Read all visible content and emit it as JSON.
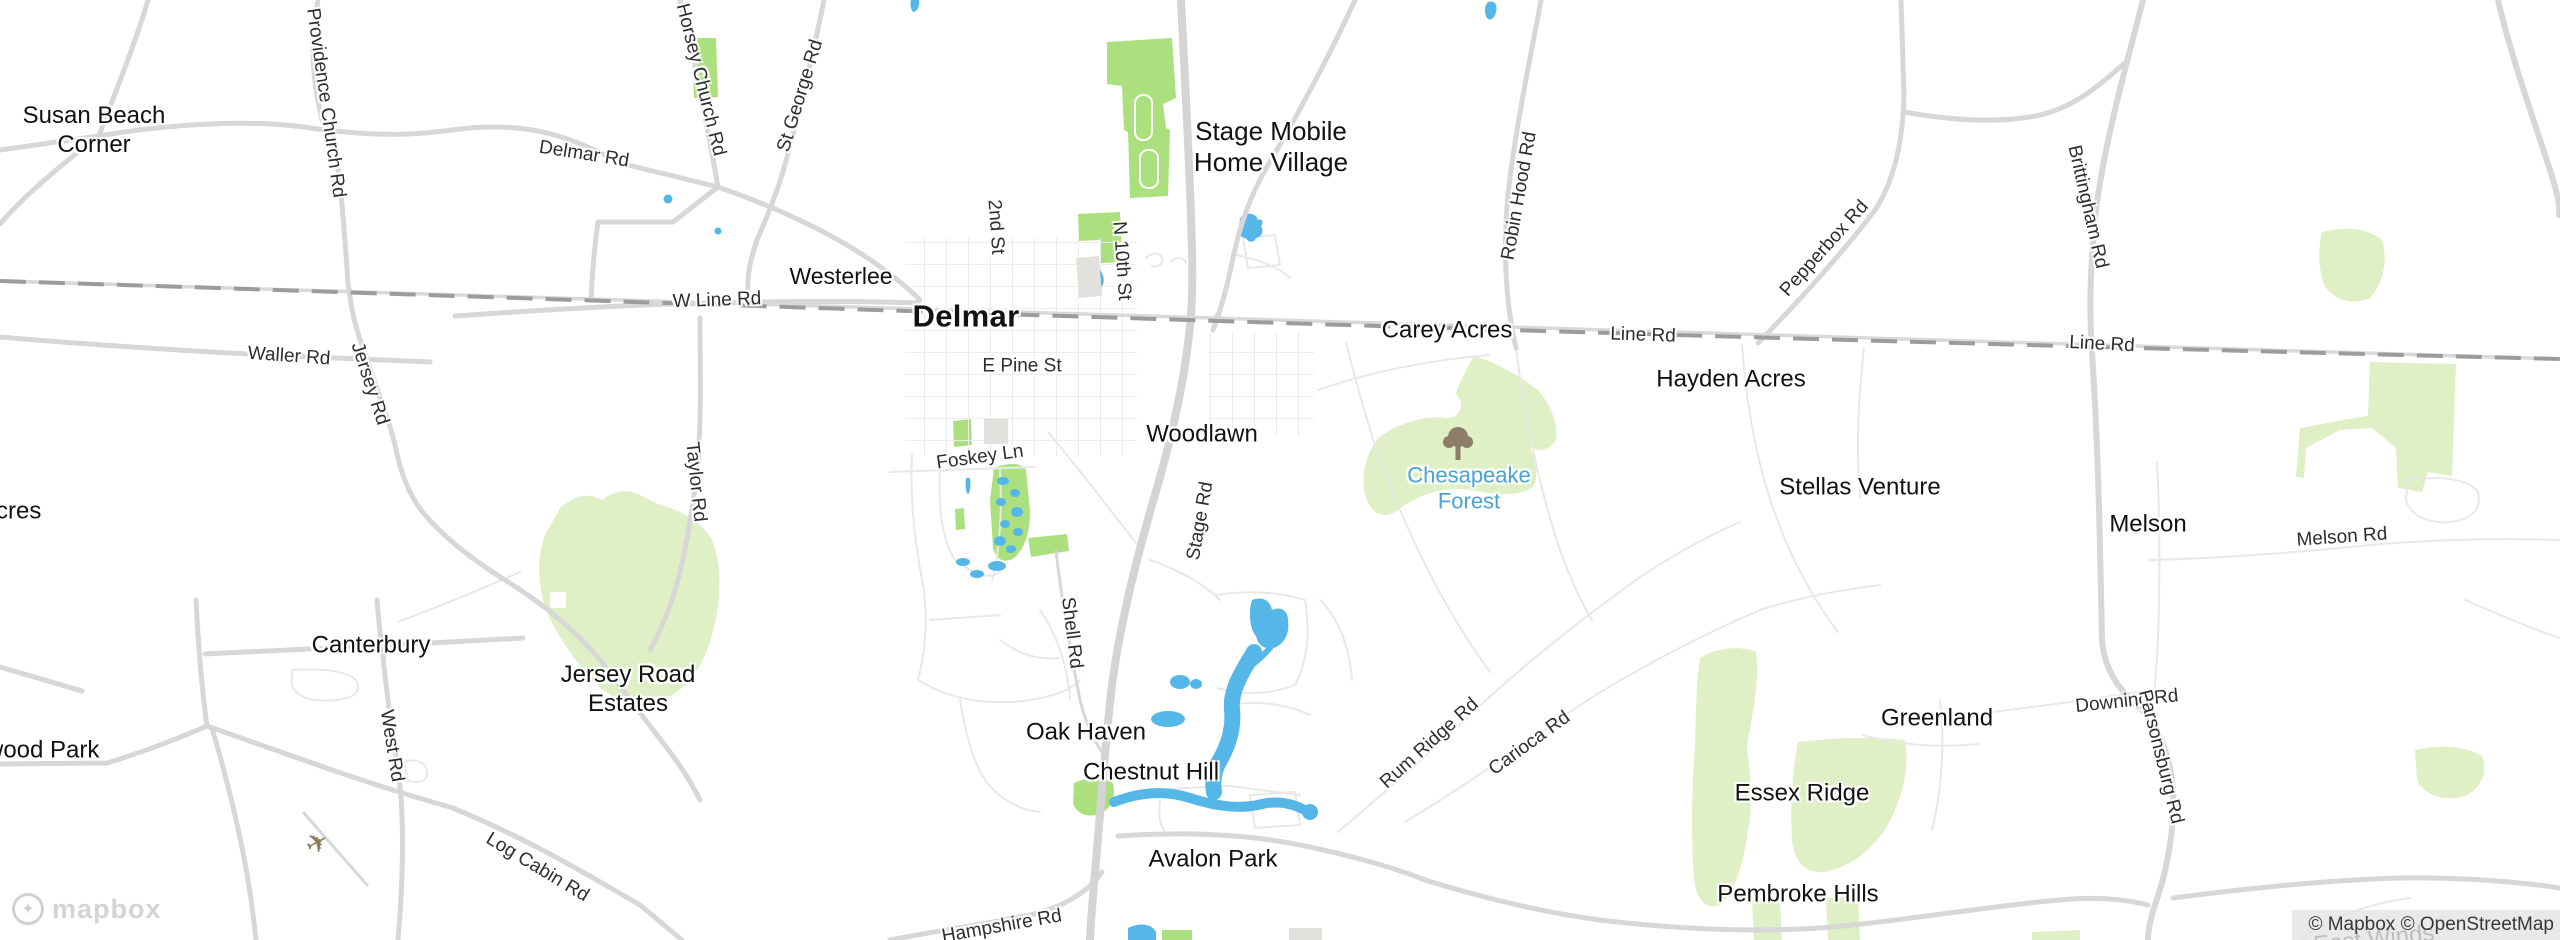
{
  "map": {
    "provider_logo": {
      "wordmark": "mapbox",
      "symbol": "✦"
    },
    "attribution": {
      "text": "© Mapbox © OpenStreetMap"
    },
    "colors": {
      "background": "#ffffff",
      "road_major": "#d4d4d4",
      "road_medium": "#d7d7d7",
      "road_minor": "#e8e8e8",
      "railroad": "#9c9c9c",
      "water": "#55b7e8",
      "park_green": "#ace07f",
      "forest_green": "#dff0c6",
      "building": "#e3e1de",
      "place_label": "#121212",
      "forest_label": "#4ba3d5"
    },
    "places": {
      "susan_beach_corner": "Susan Beach\nCorner",
      "westerlee": "Westerlee",
      "delmar": "Delmar",
      "stage_mobile_home_village": "Stage Mobile\nHome Village",
      "carey_acres": "Carey Acres",
      "hayden_acres": "Hayden Acres",
      "woodlawn": "Woodlawn",
      "stellas_venture": "Stellas Venture",
      "melson": "Melson",
      "canterbury": "Canterbury",
      "jersey_road_estates": "Jersey Road\nEstates",
      "oak_haven": "Oak Haven",
      "chestnut_hill": "Chestnut Hill",
      "avalon_park": "Avalon Park",
      "greenland": "Greenland",
      "essex_ridge": "Essex Ridge",
      "pembroke_hills": "Pembroke Hills",
      "wood_park_partial": "wood Park",
      "acres_partial": "cres",
      "east_winds": "East Winds",
      "chesapeake_forest": "Chesapeake\nForest"
    },
    "roads": {
      "providence_church_rd": "Providence Church Rd",
      "delmar_rd": "Delmar Rd",
      "horsey_church_rd": "Horsey Church Rd",
      "st_george_rd": "St George Rd",
      "second_st": "2nd St",
      "n_10th_st": "N 10th St",
      "w_line_rd": "W Line Rd",
      "e_pine_st": "E Pine St",
      "foskey_ln": "Foskey Ln",
      "taylor_rd": "Taylor Rd",
      "jersey_rd": "Jersey Rd",
      "waller_rd": "Waller Rd",
      "stage_rd": "Stage Rd",
      "shell_rd": "Shell Rd",
      "robin_hood_rd": "Robin Hood Rd",
      "pepperbox_rd": "Pepperbox Rd",
      "brittingham_rd": "Brittingham Rd",
      "line_rd_west": "Line Rd",
      "line_rd_east": "Line Rd",
      "melson_rd": "Melson Rd",
      "downing_rd": "Downing Rd",
      "parsonsburg_rd": "Parsonsburg Rd",
      "hampshire_rd": "Hampshire Rd",
      "rum_ridge_rd": "Rum Ridge Rd",
      "carioca_rd": "Carioca Rd",
      "log_cabin_rd": "Log Cabin Rd",
      "west_rd": "West Rd"
    }
  }
}
